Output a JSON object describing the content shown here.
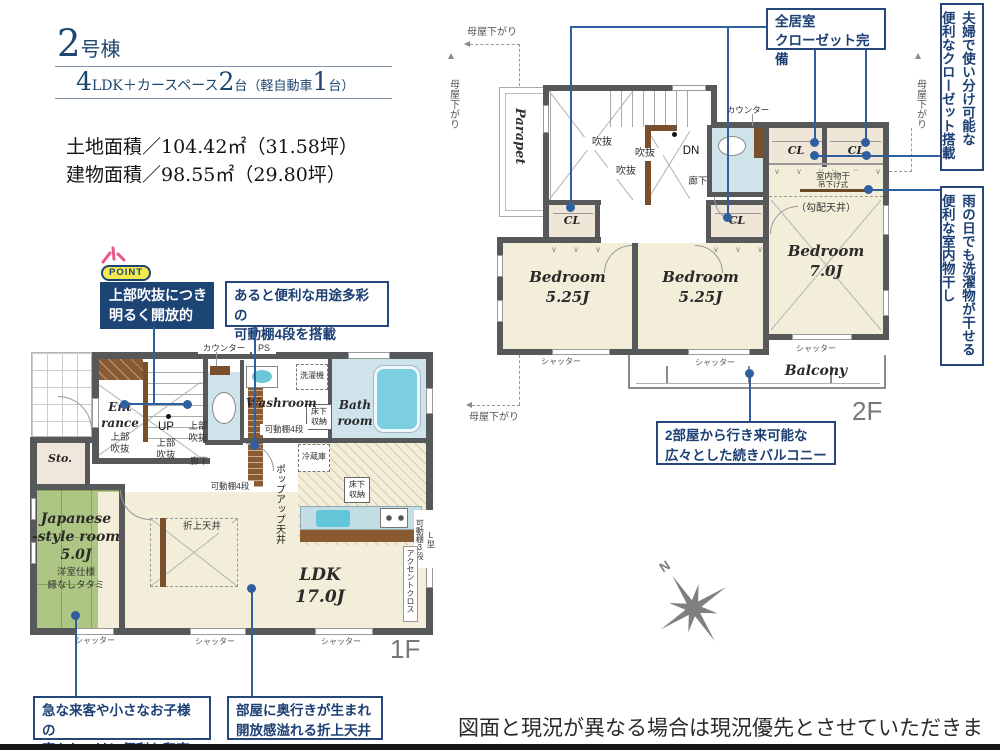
{
  "title": {
    "num": "2",
    "suffix": "号棟"
  },
  "spec": {
    "n1": "4",
    "t1": "LDK＋カースペース",
    "n2": "2",
    "t2": "台",
    "t3": "（軽自動車",
    "n3": "1",
    "t4": "台）"
  },
  "areas": {
    "land": "土地面積／104.42㎡（31.58坪）",
    "building": "建物面積／98.55㎡（29.80坪）"
  },
  "point": {
    "badge": "POINT",
    "text": "上部吹抜につき\n明るく開放的"
  },
  "callouts": {
    "shelf": "あると便利な用途多彩の\n可動棚4段を搭載",
    "washitsu": "急な来客や小さなお子様の\n寝かしつけに便利な和室",
    "ceiling": "部屋に奥行きが生まれ\n開放感溢れる折上天井",
    "closets": "全居室\nクローゼット完備",
    "balcony": "2部屋から行き来可能な\n広々とした続きバルコニー",
    "his_hers": "夫婦で使い分け可能な\n便利なクローゼット搭載",
    "drying": "雨の日でも洗濯物が干せる\n便利な室内物干し"
  },
  "f1": {
    "floor_label": "1F",
    "entrance": "Ent\nrance",
    "upper_void": "上部\n吹抜",
    "up": "UP",
    "storage": "Sto.",
    "counter": "カウンター",
    "ps": "PS",
    "washer": "洗濯機",
    "washroom": "Washroom",
    "underfloor": "床下\n収納",
    "bathroom": "Bath\nroom",
    "shelf4": "可動棚4段",
    "hall": "廊下",
    "fridge": "冷蔵庫",
    "popup_ceiling": "ポップアップ天井",
    "coffered": "折上天井",
    "jroom": "Japanese\n-style room\n5.0J",
    "jnote1": "洋室仕様",
    "jnote2": "縁なしタタミ",
    "ldk": "LDK\n17.0J",
    "l_shelf": "L型\n可動棚3段",
    "accent": "アクセントクロス",
    "shutter": "シャッター"
  },
  "f2": {
    "floor_label": "2F",
    "parapet": "Parapet",
    "moya": "母屋下がり",
    "void": "吹抜",
    "dn": "DN",
    "counter": "カウンター",
    "hall": "廊下",
    "cl": "CL",
    "drying_pole": "室内物干",
    "drying_type": "吊下げ式",
    "sloped": "（勾配天井）",
    "bedroom525": "Bedroom\n5.25J",
    "bedroom70": "Bedroom\n7.0J",
    "balcony": "Balcony",
    "shutter": "シャッター"
  },
  "compass": {
    "north": "N"
  },
  "disclaimer": "図面と現況が異なる場合は現況優先とさせていただきます。"
}
